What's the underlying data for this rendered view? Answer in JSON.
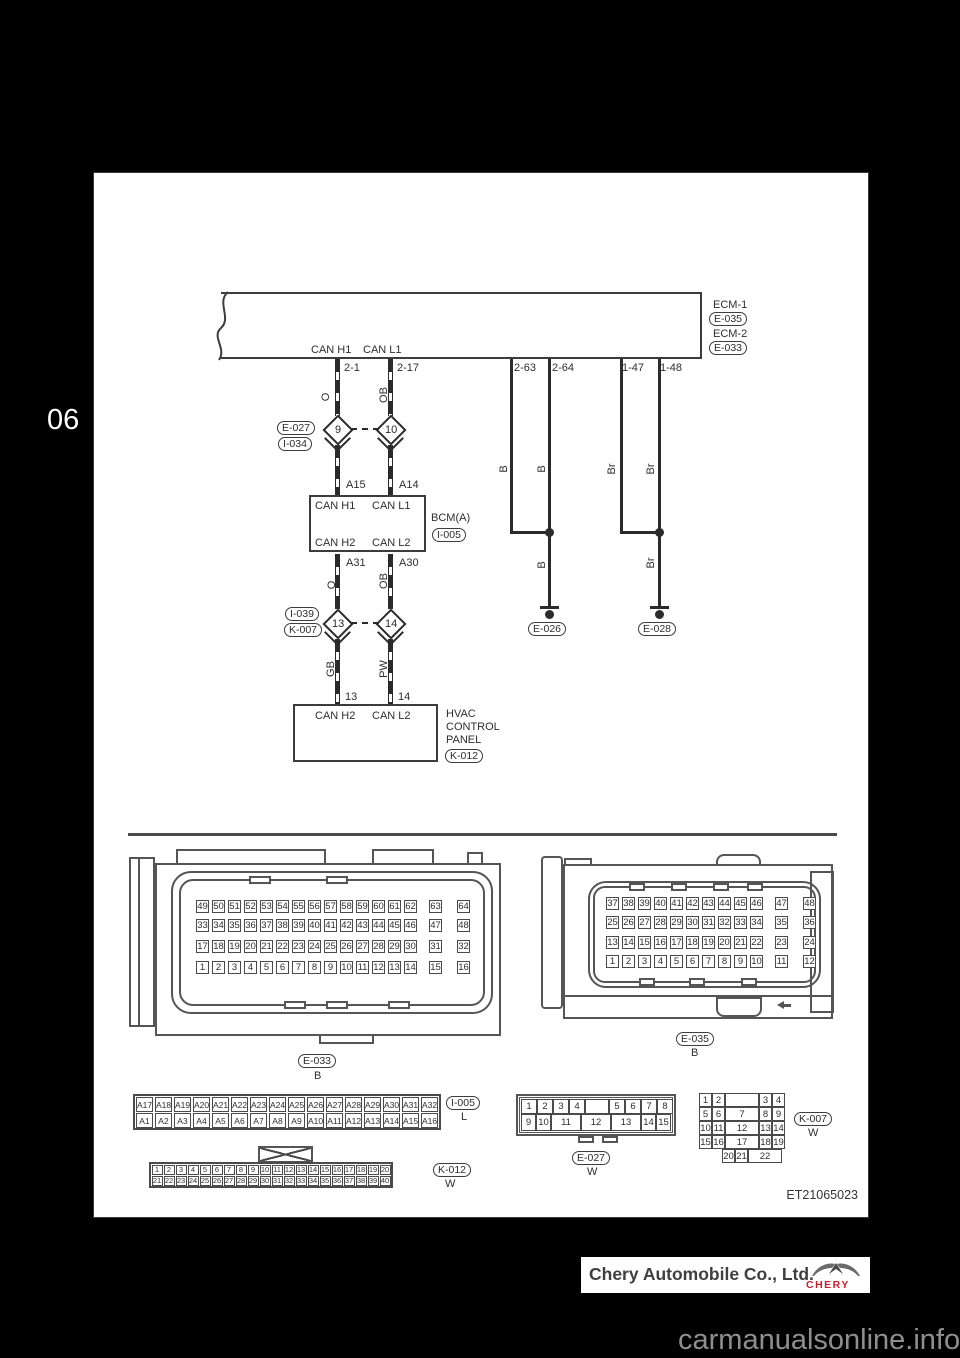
{
  "page": {
    "section_number": "06",
    "figure_code": "ET21065023",
    "watermark": "carmanualsonline.info"
  },
  "footer": {
    "company": "Chery Automobile Co., Ltd.",
    "logo_text": "CHERY",
    "logo_red": "#c8202f"
  },
  "diagram": {
    "ecm": {
      "name_1": "ECM-1",
      "code_1": "E-035",
      "name_2": "ECM-2",
      "code_2": "E-033",
      "can_h1": "CAN H1",
      "can_l1": "CAN L1"
    },
    "ecm_pins": {
      "can_h1": "2-1",
      "can_l1": "2-17",
      "gnd_1": "2-63",
      "gnd_2": "2-64",
      "gnd_3": "1-47",
      "gnd_4": "1-48"
    },
    "splice_top": {
      "code_1": "E-027",
      "code_2": "I-034",
      "left_num": "9",
      "right_num": "10"
    },
    "splice_bottom": {
      "code_1": "I-039",
      "code_2": "K-007",
      "left_num": "13",
      "right_num": "14"
    },
    "wires": {
      "h1_color": "O",
      "l1_color": "OB",
      "h2_color": "GB",
      "l2_color": "PW",
      "gnd_b": "B",
      "gnd_br": "Br"
    },
    "bcm": {
      "name": "BCM(A)",
      "code": "I-005",
      "can_h1": "CAN H1",
      "can_l1": "CAN L1",
      "can_h2": "CAN H2",
      "can_l2": "CAN L2",
      "pin_a15": "A15",
      "pin_a14": "A14",
      "pin_a31": "A31",
      "pin_a30": "A30"
    },
    "hvac": {
      "name_line1": "HVAC",
      "name_line2": "CONTROL",
      "name_line3": "PANEL",
      "code": "K-012",
      "can_h2": "CAN H2",
      "can_l2": "CAN L2",
      "pin_13": "13",
      "pin_14": "14"
    },
    "grounds": {
      "g1_code": "E-026",
      "g2_code": "E-028"
    }
  },
  "connectors": {
    "e033": {
      "code": "E-033",
      "color": "B",
      "row1": [
        "49",
        "50",
        "51",
        "52",
        "53",
        "54",
        "55",
        "56",
        "57",
        "58",
        "59",
        "60",
        "61",
        "62",
        "63",
        "64"
      ],
      "row2": [
        "33",
        "34",
        "35",
        "36",
        "37",
        "38",
        "39",
        "40",
        "41",
        "42",
        "43",
        "44",
        "45",
        "46",
        "47",
        "48"
      ],
      "row3": [
        "17",
        "18",
        "19",
        "20",
        "21",
        "22",
        "23",
        "24",
        "25",
        "26",
        "27",
        "28",
        "29",
        "30",
        "31",
        "32"
      ],
      "row4": [
        "1",
        "2",
        "3",
        "4",
        "5",
        "6",
        "7",
        "8",
        "9",
        "10",
        "11",
        "12",
        "13",
        "14",
        "15",
        "16"
      ]
    },
    "e035": {
      "code": "E-035",
      "color": "B",
      "row1": [
        "37",
        "38",
        "39",
        "40",
        "41",
        "42",
        "43",
        "44",
        "45",
        "46",
        "47",
        "48"
      ],
      "row2": [
        "25",
        "26",
        "27",
        "28",
        "29",
        "30",
        "31",
        "32",
        "33",
        "34",
        "35",
        "36"
      ],
      "row3": [
        "13",
        "14",
        "15",
        "16",
        "17",
        "18",
        "19",
        "20",
        "21",
        "22",
        "23",
        "24"
      ],
      "row4": [
        "1",
        "2",
        "3",
        "4",
        "5",
        "6",
        "7",
        "8",
        "9",
        "10",
        "11",
        "12"
      ]
    },
    "i005": {
      "code": "I-005",
      "color": "L",
      "row1": [
        "A17",
        "A18",
        "A19",
        "A20",
        "A21",
        "A22",
        "A23",
        "A24",
        "A25",
        "A26",
        "A27",
        "A28",
        "A29",
        "A30",
        "A31",
        "A32"
      ],
      "row2": [
        "A1",
        "A2",
        "A3",
        "A4",
        "A5",
        "A6",
        "A7",
        "A8",
        "A9",
        "A10",
        "A11",
        "A12",
        "A13",
        "A14",
        "A15",
        "A16"
      ]
    },
    "k012": {
      "code": "K-012",
      "color": "W",
      "row1": [
        "1",
        "2",
        "3",
        "4",
        "5",
        "6",
        "7",
        "8",
        "9",
        "10",
        "11",
        "12",
        "13",
        "14",
        "15",
        "16",
        "17",
        "18",
        "19",
        "20"
      ],
      "row2": [
        "21",
        "22",
        "23",
        "24",
        "25",
        "26",
        "27",
        "28",
        "29",
        "30",
        "31",
        "32",
        "33",
        "34",
        "35",
        "36",
        "37",
        "38",
        "39",
        "40"
      ]
    },
    "e027": {
      "code": "E-027",
      "color": "W",
      "row1": [
        "1",
        "2",
        "3",
        "4",
        "",
        "5",
        "6",
        "7",
        "8"
      ],
      "row2": [
        "9",
        "10",
        "11",
        "12",
        "13",
        "14",
        "15"
      ]
    },
    "k007": {
      "code": "K-007",
      "color": "W",
      "row1": [
        "1",
        "2",
        "",
        "3",
        "4"
      ],
      "row2": [
        "5",
        "6",
        "7",
        "8",
        "9"
      ],
      "row3": [
        "10",
        "11",
        "12",
        "13",
        "14"
      ],
      "row4": [
        "15",
        "16",
        "17",
        "18",
        "19"
      ],
      "row5": [
        "20",
        "21",
        "22"
      ]
    }
  }
}
